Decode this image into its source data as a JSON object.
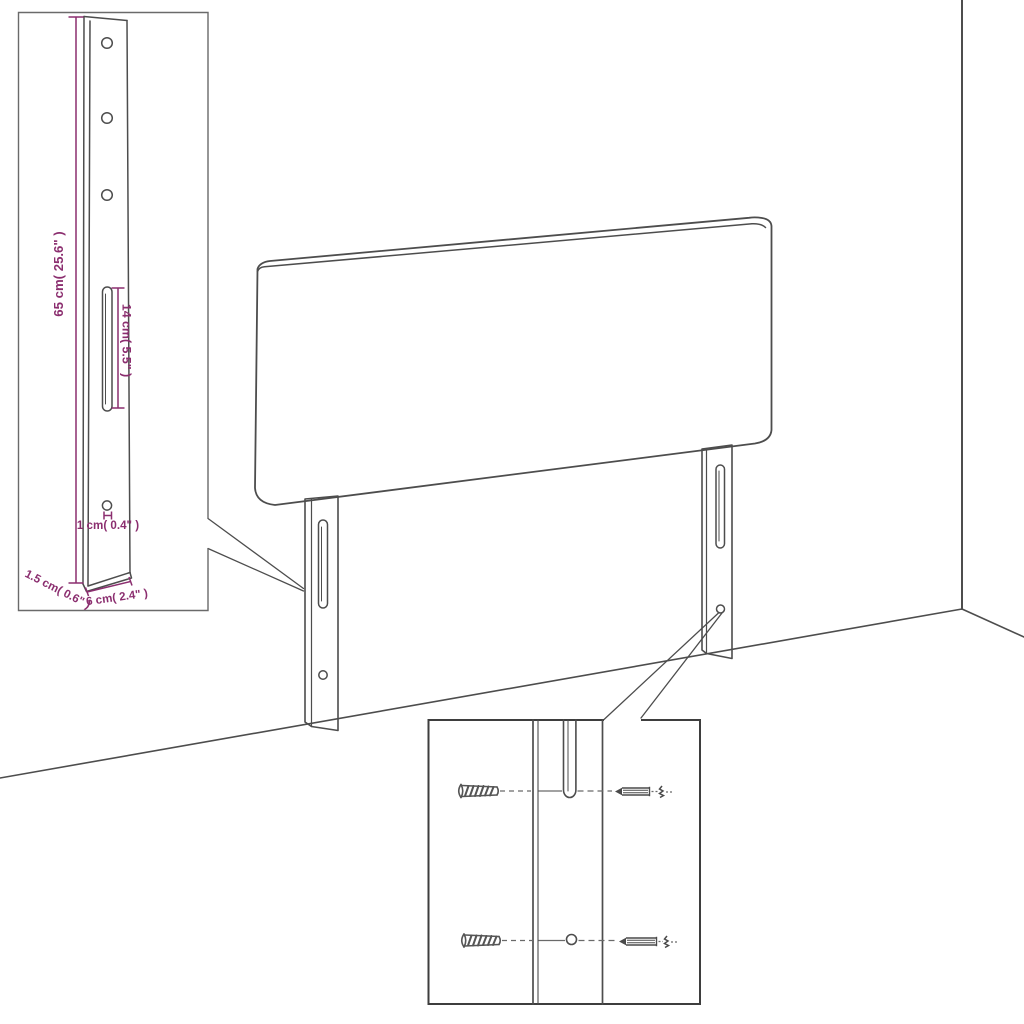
{
  "figure": {
    "title": "Headboard assembly dimension diagram",
    "background_color": "#ffffff",
    "line_color": "#4d4d4d",
    "accent_color": "#8b2e6f"
  },
  "labels": {
    "leg_height": "65 cm( 25.6\" )",
    "slot_length": "14 cm( 5.5\" )",
    "hole_size": "1 cm( 0.4\" )",
    "leg_depth": "1.5 cm( 0.6\" )",
    "leg_width": "6 cm( 2.4\" )"
  },
  "icons": {
    "wall_plug": "wall-plug-icon",
    "screw": "screw-icon",
    "mounting_slot": "mounting-slot",
    "mounting_hole": "mounting-hole"
  }
}
